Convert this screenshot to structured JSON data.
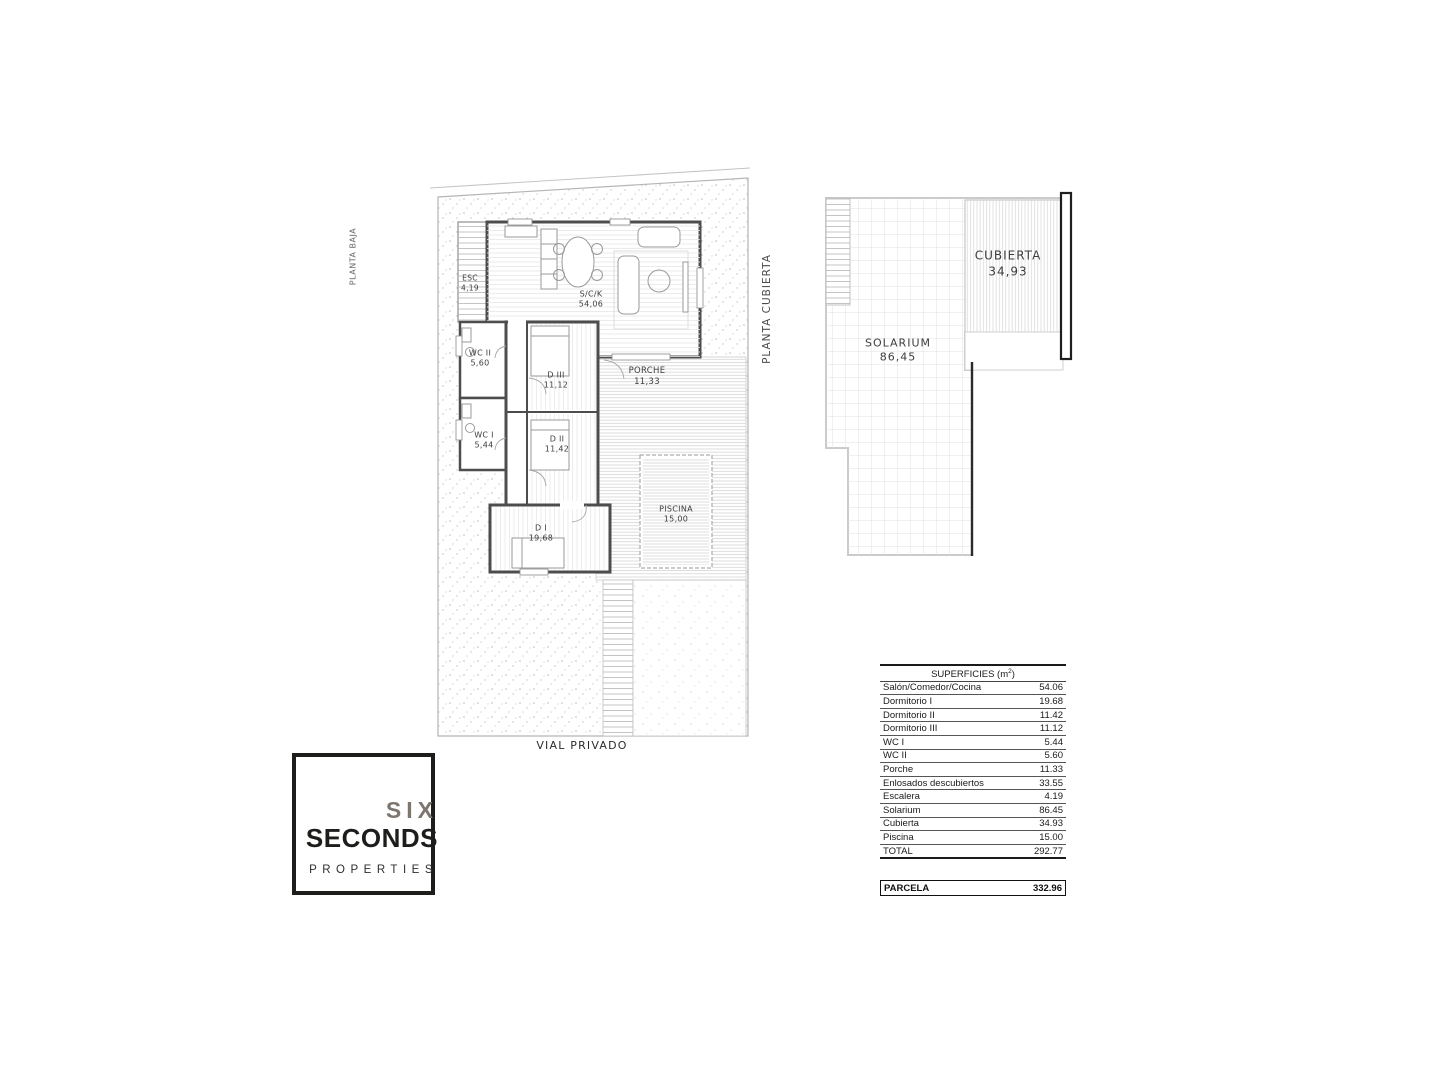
{
  "ground_floor": {
    "orientation_label": "PLANTA BAJA",
    "street_label": "VIAL PRIVADO",
    "rooms": [
      {
        "name": "ESC",
        "area": "4,19"
      },
      {
        "name": "S/C/K",
        "area": "54,06"
      },
      {
        "name": "WC II",
        "area": "5,60"
      },
      {
        "name": "D III",
        "area": "11,12"
      },
      {
        "name": "PORCHE",
        "area": "11,33"
      },
      {
        "name": "WC I",
        "area": "5,44"
      },
      {
        "name": "D II",
        "area": "11,42"
      },
      {
        "name": "D I",
        "area": "19,68"
      },
      {
        "name": "PISCINA",
        "area": "15,00"
      }
    ]
  },
  "roof_plan": {
    "orientation_label": "PLANTA CUBIERTA",
    "rooms": [
      {
        "name": "SOLARIUM",
        "area": "86,45"
      },
      {
        "name": "CUBIERTA",
        "area": "34,93"
      }
    ]
  },
  "surfaces_table": {
    "title_prefix": "SUPERFICIES (m",
    "title_sup": "2",
    "title_suffix": ")",
    "rows": [
      {
        "label": "Salón/Comedor/Cocina",
        "value": "54.06"
      },
      {
        "label": "Dormitorio I",
        "value": "19.68"
      },
      {
        "label": "Dormitorio II",
        "value": "11.42"
      },
      {
        "label": "Dormitorio III",
        "value": "11.12"
      },
      {
        "label": "WC I",
        "value": "5.44"
      },
      {
        "label": "WC II",
        "value": "5.60"
      },
      {
        "label": "Porche",
        "value": "11.33"
      },
      {
        "label": "Enlosados descubiertos",
        "value": "33.55"
      },
      {
        "label": "Escalera",
        "value": "4.19"
      },
      {
        "label": "Solarium",
        "value": "86.45"
      },
      {
        "label": "Cubierta",
        "value": "34.93"
      },
      {
        "label": "Piscina",
        "value": "15.00"
      }
    ],
    "total_row": {
      "label": "TOTAL",
      "value": "292.77"
    },
    "parcela_row": {
      "label": "PARCELA",
      "value": "332.96"
    }
  },
  "logo": {
    "word1": "SIX",
    "word2": "SECONDS",
    "word3": "PROPERTIES"
  },
  "colors": {
    "wall": "#4d4d4d",
    "logo_gray": "#7c766f",
    "logo_black": "#1d1d1b"
  }
}
